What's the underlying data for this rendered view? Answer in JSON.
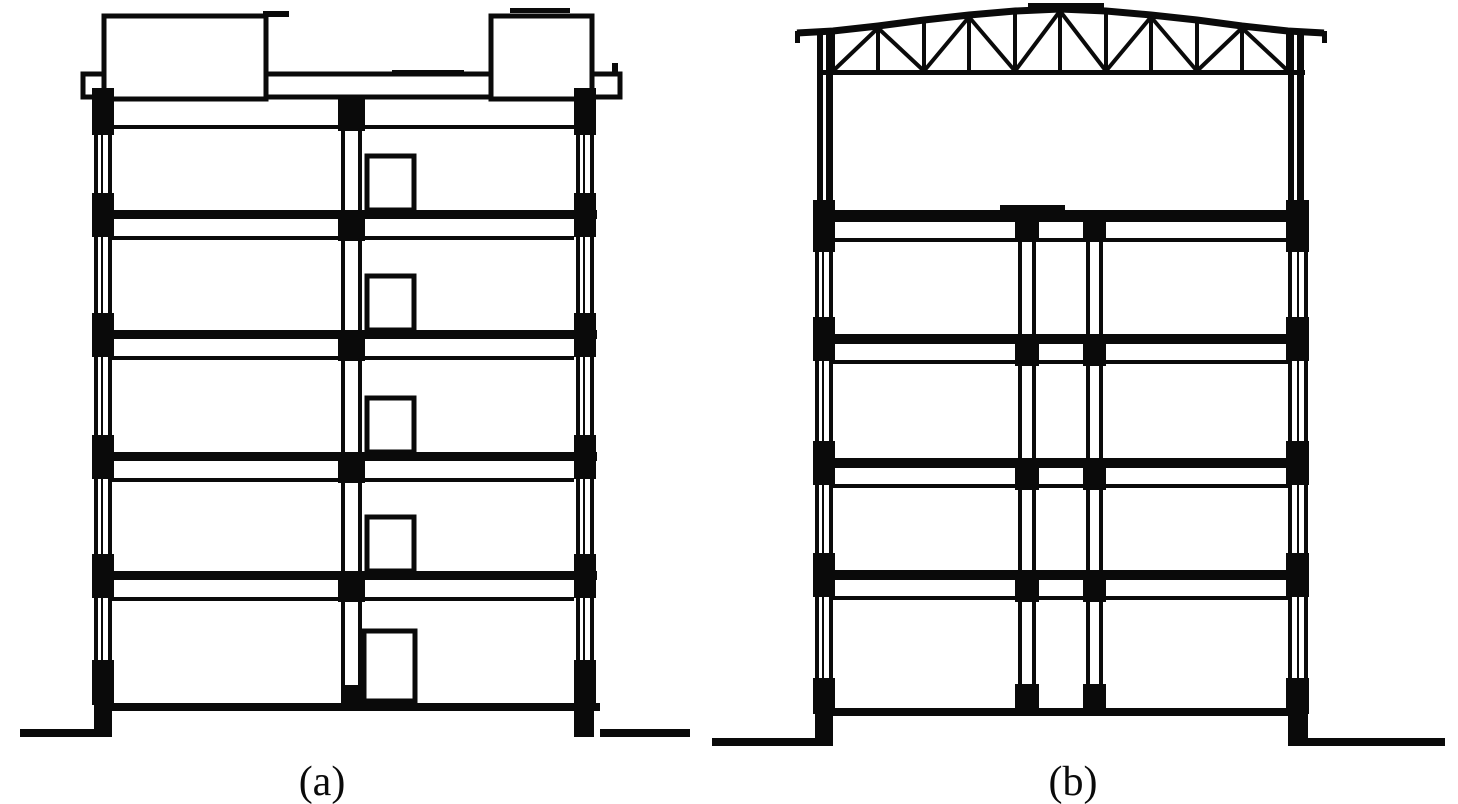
{
  "figure": {
    "type": "building-cross-section-diagram",
    "colors": {
      "ink": "#0a0a0a",
      "paper": "#ffffff"
    },
    "panels": [
      {
        "id": "a",
        "label": "(a)"
      },
      {
        "id": "b",
        "label": "(b)"
      }
    ]
  }
}
